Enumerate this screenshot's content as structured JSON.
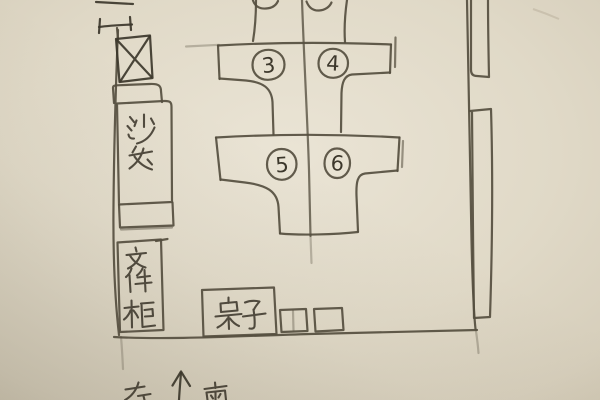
{
  "palette": {
    "paper_center": "#eae4d5",
    "paper_mid": "#e0d9c7",
    "paper_edge": "#c9c0ab",
    "pencil": "#554e3f",
    "pencil_dark": "#3c372b"
  },
  "sketch": {
    "furniture": {
      "sofa_label": "沙发",
      "cabinet_label": "文件柜",
      "table_label": "桌子"
    },
    "desk_numbers": [
      "3",
      "4",
      "5",
      "6"
    ],
    "compass": {
      "left_char": "左",
      "south_char": "南"
    }
  }
}
